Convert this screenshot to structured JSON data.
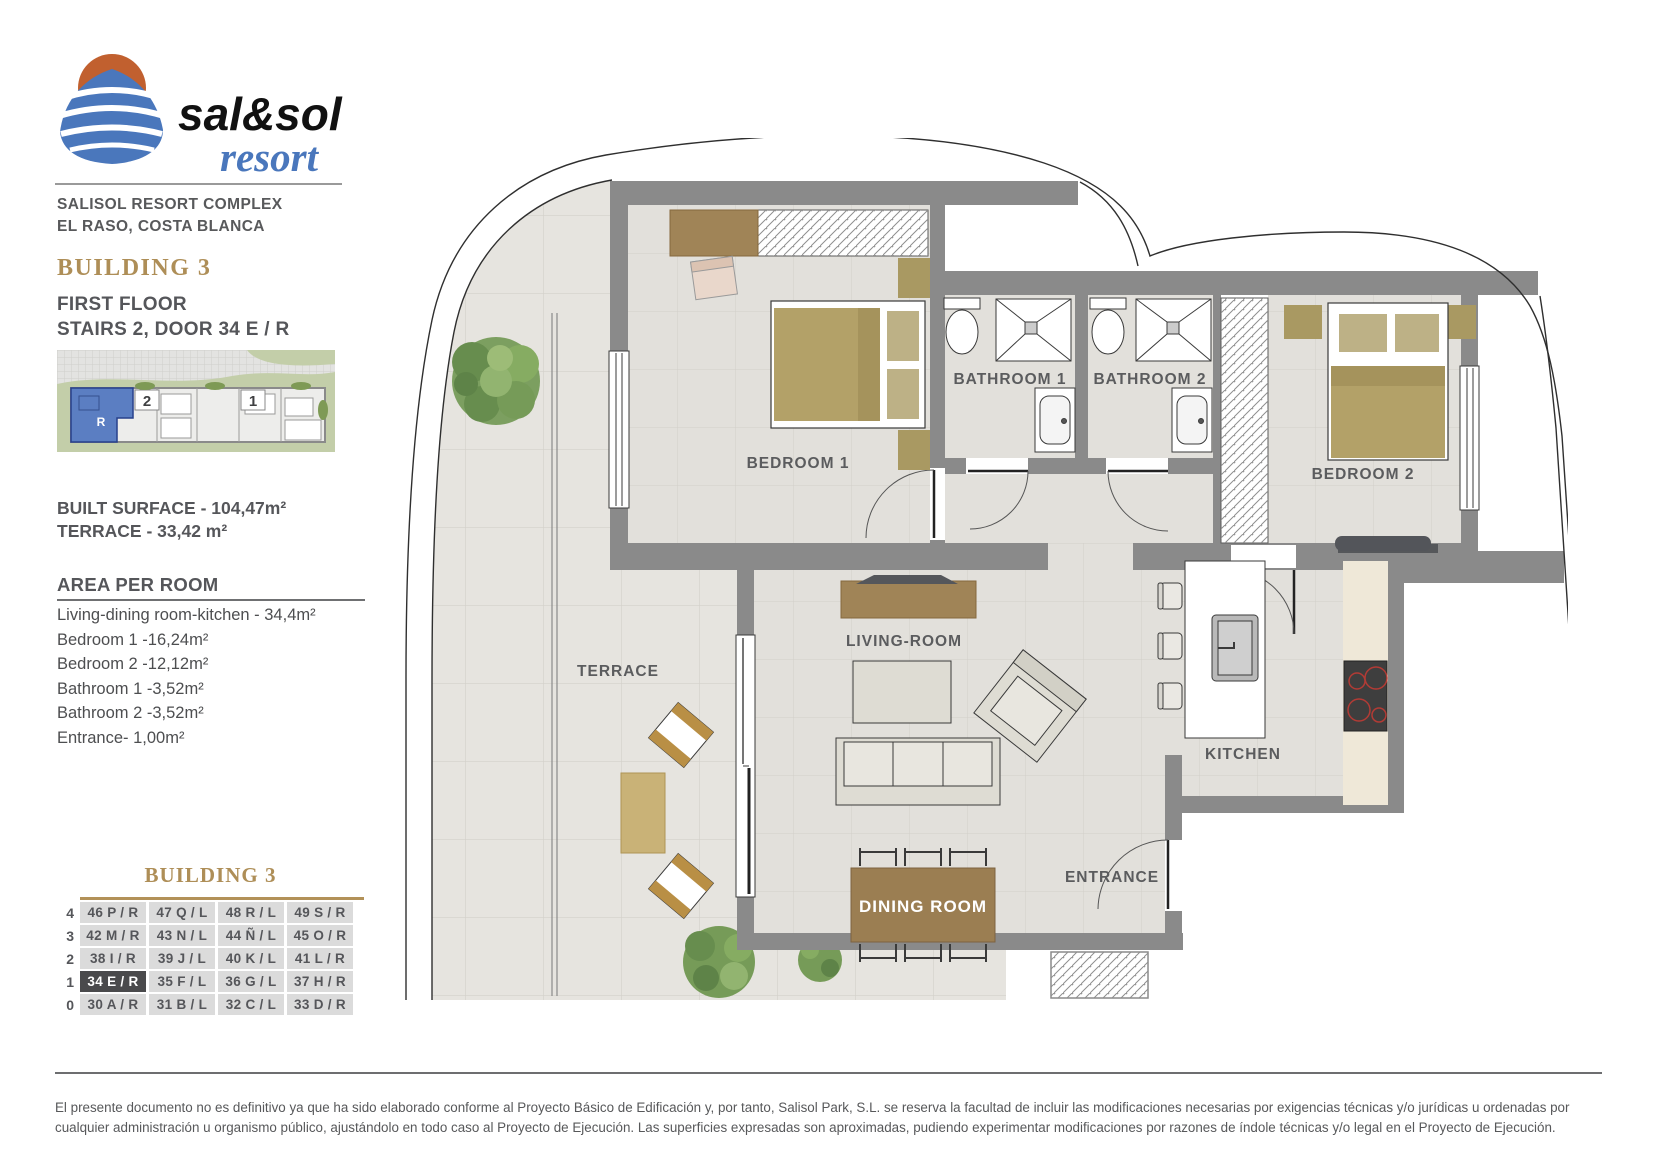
{
  "branding": {
    "name1": "sal&sol",
    "name2": "resort",
    "complex": "SALISOL RESORT COMPLEX",
    "location": "EL RASO, COSTA BLANCA"
  },
  "unit": {
    "building": "BUILDING 3",
    "floor": "FIRST FLOOR",
    "stairs_door": "STAIRS 2, DOOR 34 E / R",
    "site_unit_label": "R",
    "site_stair_2": "2",
    "site_stair_1": "1"
  },
  "surfaces": {
    "built": "BUILT SURFACE  - 104,47m²",
    "terrace": "TERRACE - 33,42 m²"
  },
  "area_per_room": {
    "title": "AREA PER ROOM",
    "items": [
      "Living-dining room-kitchen - 34,4m²",
      "Bedroom 1 -16,24m²",
      "Bedroom 2 -12,12m²",
      "Bathroom 1 -3,52m²",
      "Bathroom 2 -3,52m²",
      "Entrance- 1,00m²"
    ]
  },
  "plan": {
    "rooms": {
      "bedroom1": "BEDROOM 1",
      "bathroom1": "BATHROOM 1",
      "bathroom2": "BATHROOM 2",
      "bedroom2": "BEDROOM 2",
      "terrace": "TERRACE",
      "living": "LIVING-ROOM",
      "kitchen": "KITCHEN",
      "dining": "DINING ROOM",
      "entrance": "ENTRANCE"
    }
  },
  "units_table": {
    "title": "BUILDING 3",
    "rows": [
      {
        "floor": "4",
        "cells": [
          "46 P / R",
          "47 Q / L",
          "48 R / L",
          "49 S / R"
        ],
        "highlight": -1
      },
      {
        "floor": "3",
        "cells": [
          "42 M / R",
          "43 N / L",
          "44 Ñ / L",
          "45 O / R"
        ],
        "highlight": -1
      },
      {
        "floor": "2",
        "cells": [
          "38 I / R",
          "39 J / L",
          "40 K / L",
          "41 L / R"
        ],
        "highlight": -1
      },
      {
        "floor": "1",
        "cells": [
          "34 E / R",
          "35 F / L",
          "36 G / L",
          "37 H / R"
        ],
        "highlight": 0
      },
      {
        "floor": "0",
        "cells": [
          "30 A / R",
          "31 B / L",
          "32 C / L",
          "33 D / R"
        ],
        "highlight": -1
      }
    ]
  },
  "disclaimer": {
    "text": "El presente documento no es definitivo ya que ha sido elaborado conforme al Proyecto Básico de Edificación y, por tanto, Salisol Park, S.L. se reserva la facultad de incluir las modificaciones necesarias por exigencias técnicas y/o jurídicas u ordenadas por cualquier administración u organismo público, ajustándolo en todo caso al Proyecto de Ejecución. Las superficies expresadas son aproximadas, pudiendo experimentar modificaciones por razones de índole técnicas y/o legal en el Proyecto de Ejecución."
  },
  "colors": {
    "gold": "#AE8E57",
    "logo_orange": "#C1602F",
    "logo_blue": "#4A77BC",
    "wall_gray": "#8A8A8A",
    "highlight_cell": "#4A4A4C",
    "site_unit_blue": "#5B7EC2"
  }
}
